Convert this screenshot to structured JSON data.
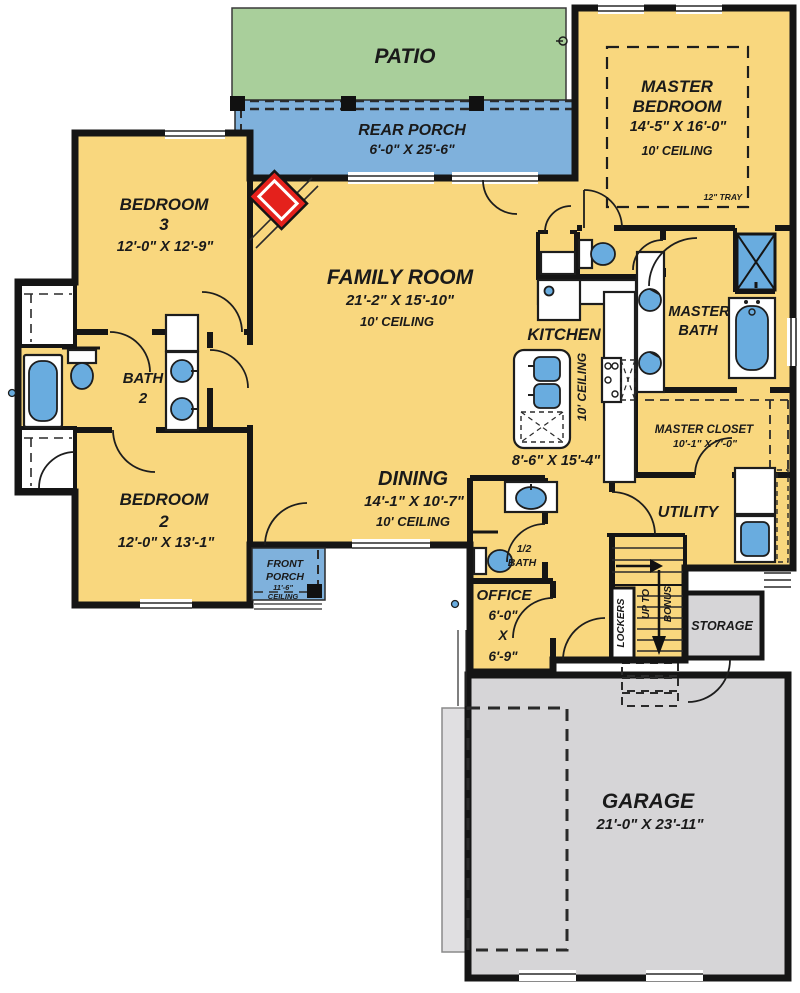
{
  "colors": {
    "floor_yellow": "#F9D77E",
    "porch_blue": "#7FB1DC",
    "patio_green": "#A9CF9B",
    "garage_gray": "#D6D5D7",
    "pad_gray": "#E0DFE1",
    "fixture_blue": "#69ACDF",
    "fireplace_red": "#E4211C",
    "wall_black": "#151515"
  },
  "rooms": {
    "patio": {
      "name": "PATIO"
    },
    "rear_porch": {
      "name": "REAR PORCH",
      "dims": "6'-0\" X 25'-6\""
    },
    "master_bedroom": {
      "name_line1": "MASTER",
      "name_line2": "BEDROOM",
      "dims": "14'-5\" X 16'-0\"",
      "ceiling": "10' CEILING",
      "tray": "12\" TRAY"
    },
    "bedroom3": {
      "name_line1": "BEDROOM",
      "name_line2": "3",
      "dims": "12'-0\" X 12'-9\""
    },
    "family_room": {
      "name": "FAMILY ROOM",
      "dims": "21'-2\" X 15'-10\"",
      "ceiling": "10' CEILING"
    },
    "kitchen": {
      "name": "KITCHEN",
      "ceiling": "10' CEILING",
      "dims": "8'-6\" X 15'-4\""
    },
    "bath2": {
      "name_line1": "BATH",
      "name_line2": "2"
    },
    "bedroom2": {
      "name_line1": "BEDROOM",
      "name_line2": "2",
      "dims": "12'-0\" X 13'-1\""
    },
    "dining": {
      "name": "DINING",
      "dims": "14'-1\" X 10'-7\"",
      "ceiling": "10' CEILING"
    },
    "master_bath": {
      "name_line1": "MASTER",
      "name_line2": "BATH"
    },
    "master_closet": {
      "name": "MASTER CLOSET",
      "dims": "10'-1\" X 7'-0\""
    },
    "utility": {
      "name": "UTILITY"
    },
    "half_bath": {
      "name_line1": "1/2",
      "name_line2": "BATH"
    },
    "office": {
      "name": "OFFICE",
      "dim_line1": "6'-0\"",
      "dim_line2": "X",
      "dim_line3": "6'-9\""
    },
    "front_porch": {
      "name_line1": "FRONT",
      "name_line2": "PORCH",
      "ceil_line1": "11'-6\"",
      "ceil_line2": "CEILING"
    },
    "garage": {
      "name": "GARAGE",
      "dims": "21'-0\" X 23'-11\""
    },
    "storage": {
      "name": "STORAGE"
    },
    "lockers": {
      "name": "LOCKERS"
    },
    "stairs": {
      "label_line1": "UP TO",
      "label_line2": "BONUS"
    }
  }
}
